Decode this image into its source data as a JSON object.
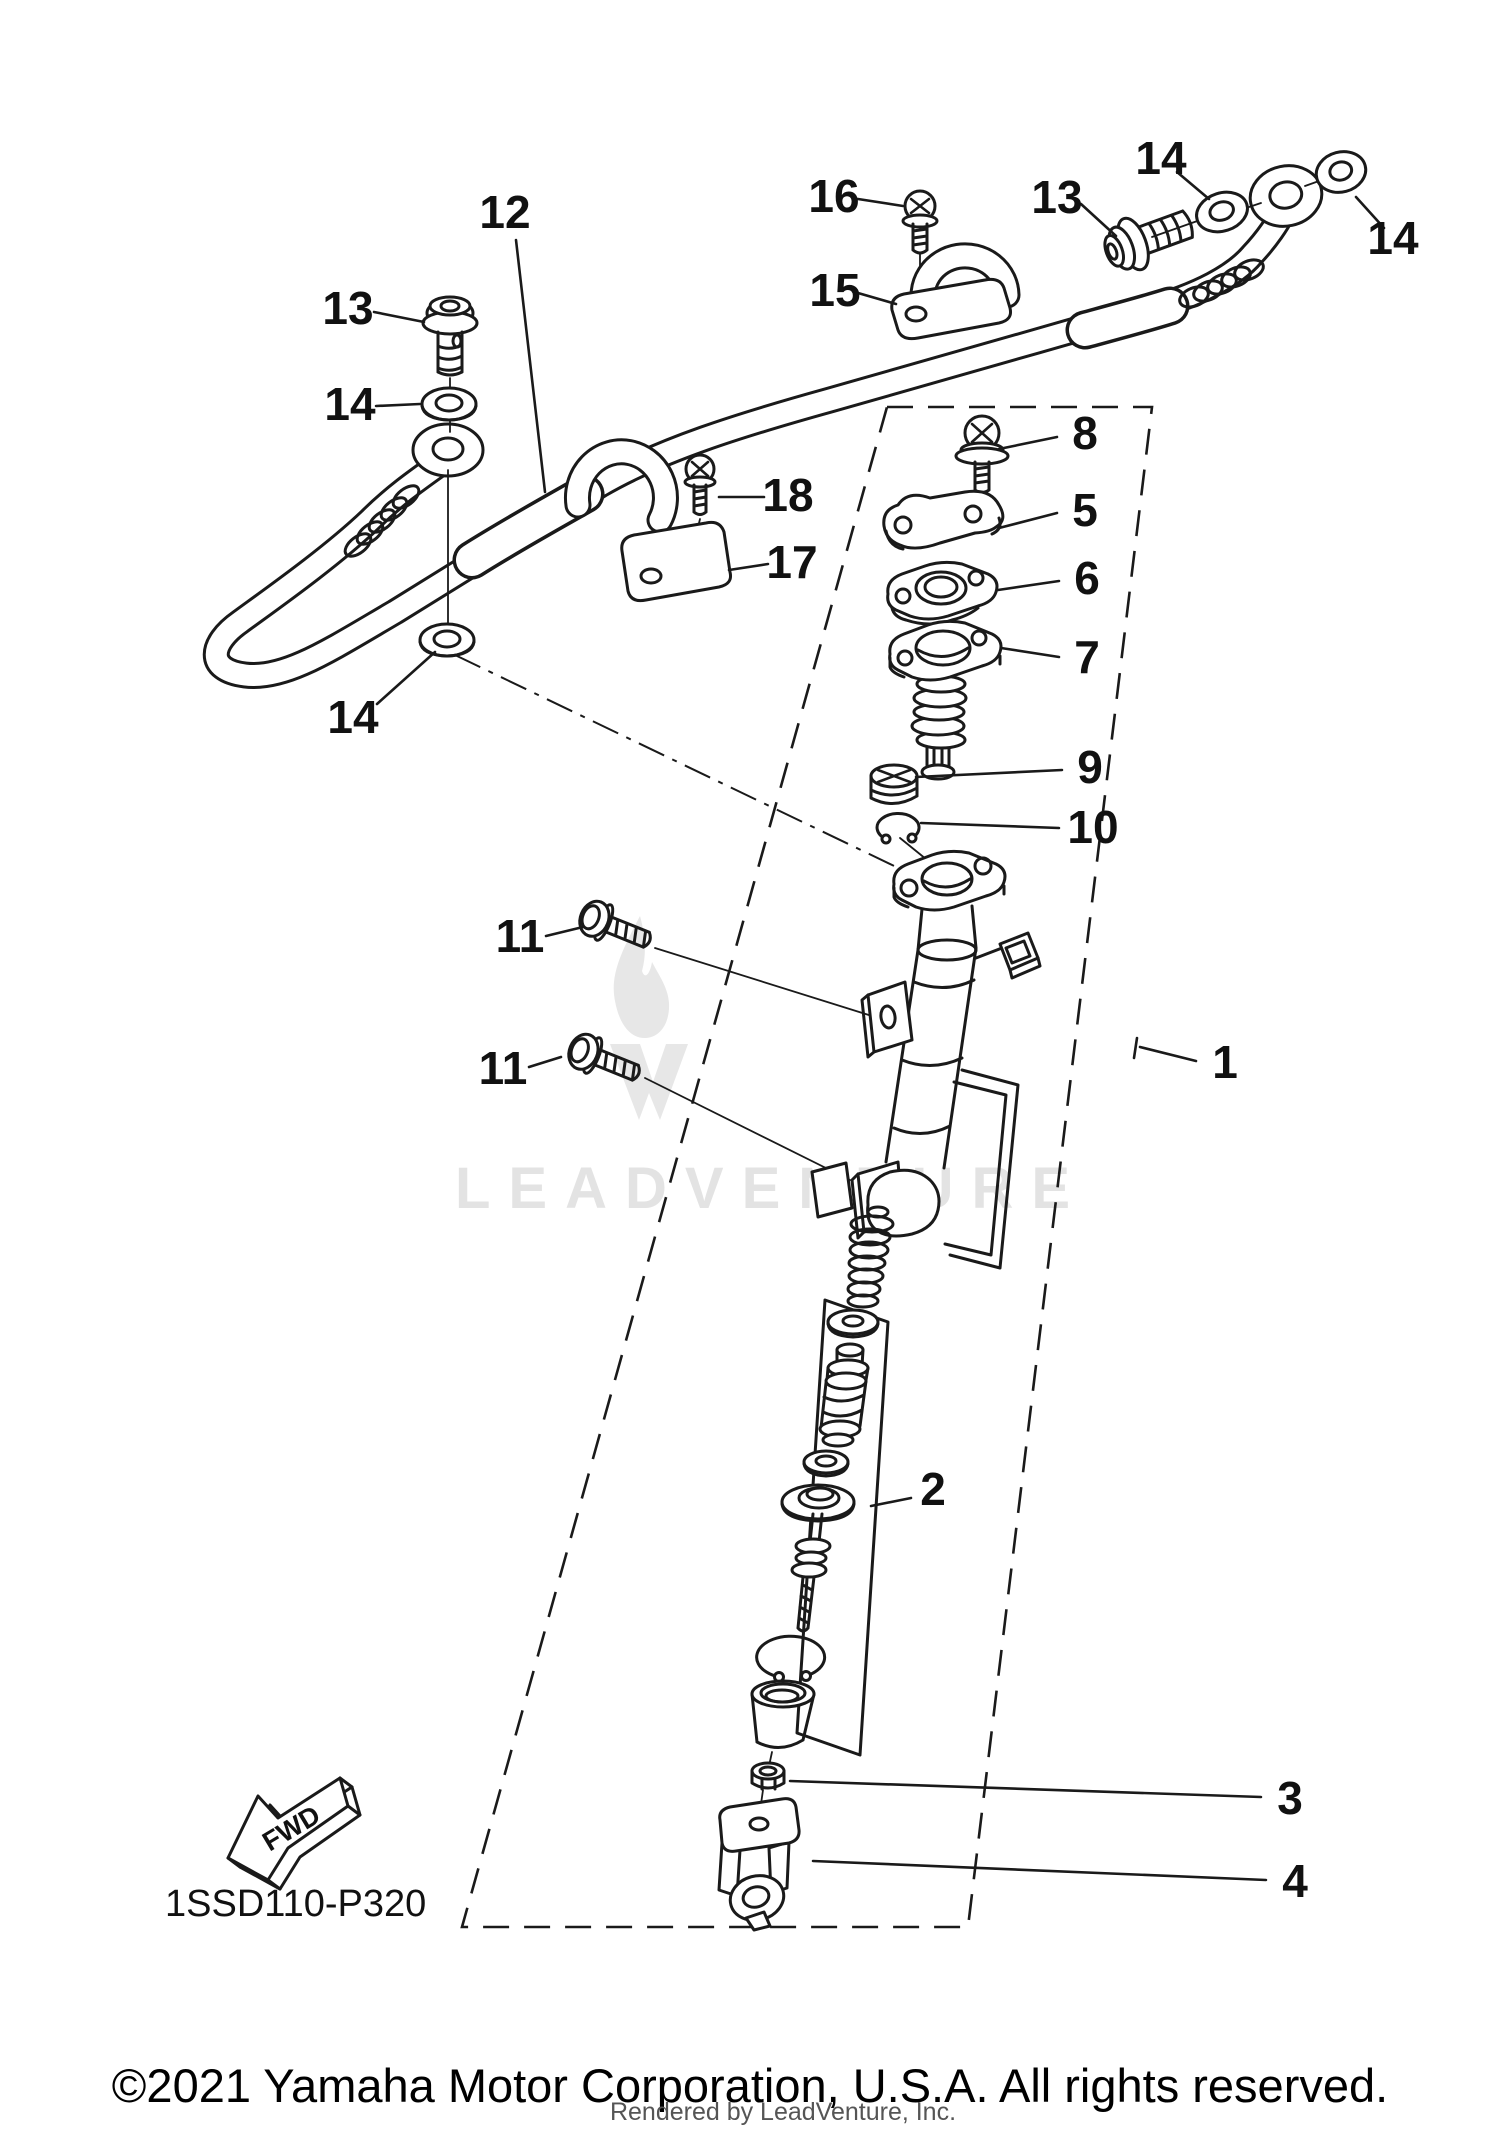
{
  "page": {
    "background": "#ffffff",
    "line_color": "#1a1a1a",
    "watermark_color": "#e3e3e3"
  },
  "watermark": {
    "text": "LEADVENTURE",
    "logo": "flame-v-icon"
  },
  "stamp": {
    "code": "1SSD110-P320",
    "fwd": "FWD"
  },
  "footer": {
    "copyright": "©2021 Yamaha Motor Corporation, U.S.A. All rights reserved.",
    "rendered_by": "Rendered by LeadVenture, Inc."
  },
  "callouts": {
    "p1": {
      "label": "1"
    },
    "p2": {
      "label": "2"
    },
    "p3": {
      "label": "3"
    },
    "p4": {
      "label": "4"
    },
    "p5": {
      "label": "5"
    },
    "p6": {
      "label": "6"
    },
    "p7": {
      "label": "7"
    },
    "p8": {
      "label": "8"
    },
    "p9": {
      "label": "9"
    },
    "p10": {
      "label": "10"
    },
    "p11": {
      "label": "11"
    },
    "p12": {
      "label": "12"
    },
    "p13": {
      "label": "13"
    },
    "p14": {
      "label": "14"
    },
    "p15": {
      "label": "15"
    },
    "p16": {
      "label": "16"
    },
    "p17": {
      "label": "17"
    },
    "p18": {
      "label": "18"
    }
  }
}
